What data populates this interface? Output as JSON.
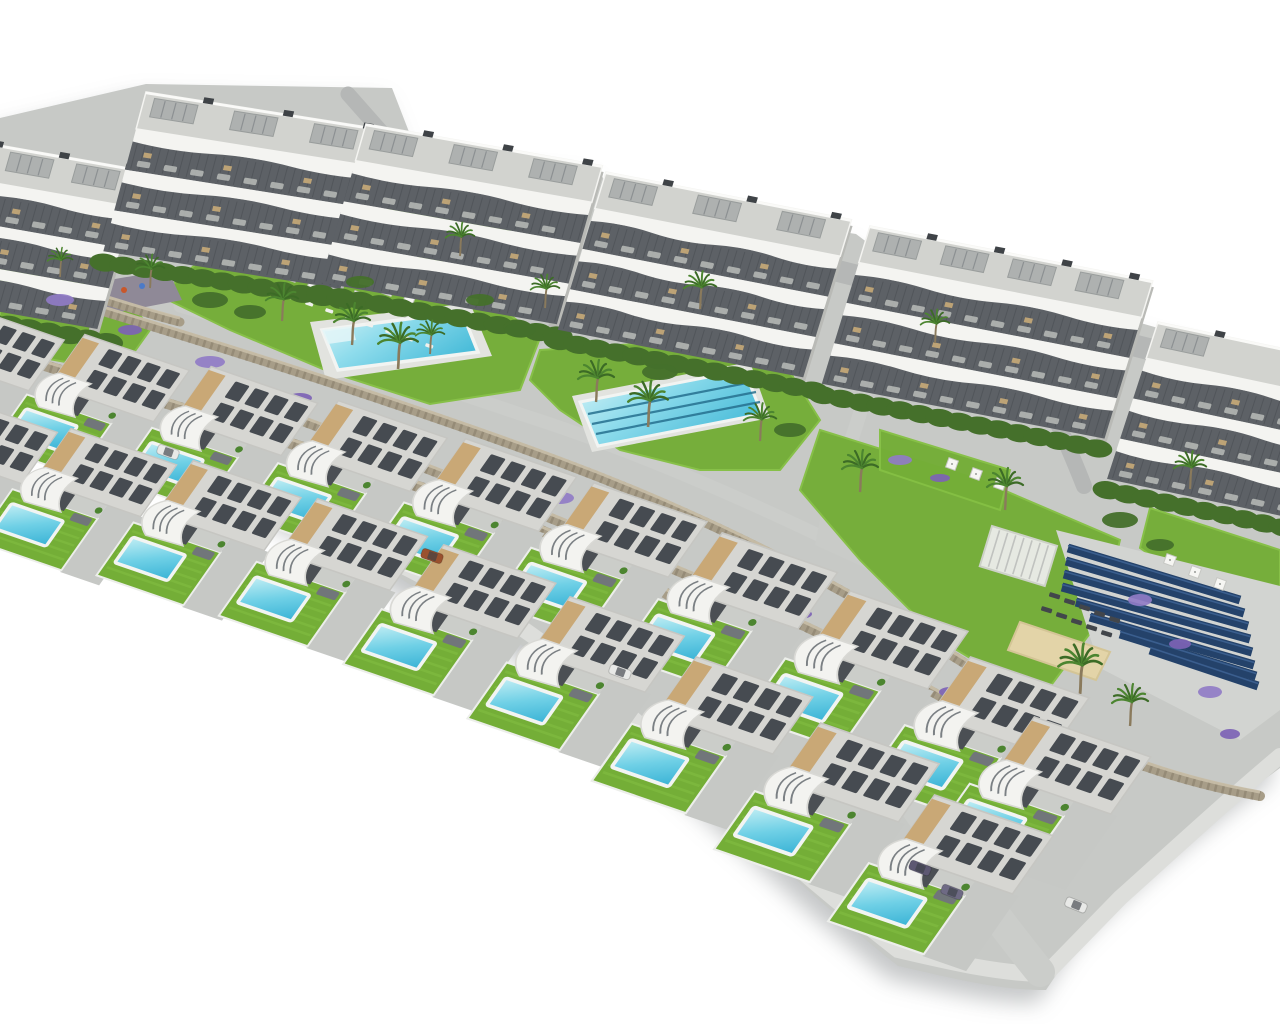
{
  "image": {
    "kind": "aerial-architectural-render",
    "description": "Aerial 3D rendering of a hillside residential development: six curved-balcony apartment blocks at the back, communal gardens with a leisure pool and a lap pool, stone terracing walls, palm trees and lavender, a pergola, sunbeds, a sand court and a solar panel field, and two staggered rows of modern villas with private pools in front, on a white background",
    "background": "#ffffff"
  },
  "palette": {
    "concrete_base": "#c7c9c6",
    "sidewalk": "#dddedb",
    "road": "#b5b7b6",
    "path": "#cbcdca",
    "plaza": "#c9cbc8",
    "lawn": "#74ae37",
    "lawn_light": "#85c044",
    "hedge_dark": "#45702b",
    "hedge_light": "#548833",
    "pool_deck": "#e2e3df",
    "pool_rim": "#f2f4f2",
    "water_light": "#c2eef4",
    "water_mid": "#6fd0e6",
    "water_deep": "#38b2d5",
    "lane_line": "#26708f",
    "stone_light": "#c9bfa8",
    "stone_mid": "#a79d88",
    "stone_dark": "#837a66",
    "lavender": "#7d63b5",
    "lavender_light": "#907cc6",
    "palm_frond": "#4c8530",
    "palm_frond_dark": "#3c6b26",
    "palm_trunk": "#8a7a5c",
    "building_white": "#f4f4f1",
    "building_recess": "#5d6166",
    "building_slat": "#474b50",
    "building_deck": "#d2d3cf",
    "building_pergola": "#aeb1b0",
    "building_shade": "#b9bab6",
    "villa_roof": "#d6d6d2",
    "villa_roof_edge": "#c6c6c2",
    "villa_panel": "#464b51",
    "villa_beige": "#c9a876",
    "villa_white": "#f3f3f0",
    "villa_stair": "#7b8084",
    "villa_terrace": "#cbcdc9",
    "villa_sofa": "#71767a",
    "driveway": "#c6c8c5",
    "porch_dark": "#4b4f54",
    "solar_pad": "#d2d4d1",
    "solar_panel": "#24426a",
    "solar_panel_light": "#3a5e8e",
    "sand": "#e3d4a8",
    "playground": "#8f8997",
    "umbrella": "#f6f6f3",
    "sunbed_dark": "#42464b",
    "furniture_light": "#b9bcb9",
    "furniture_tan": "#c8ab78"
  },
  "scene": {
    "site_outline": "M0,118 L146,84 L392,88 L416,150 L598,168 L612,196 L856,234 L872,246 L1158,328 L1280,360 L1280,768 C1236,800 1150,866 1082,936 L1046,990 C996,990 952,978 898,966 C806,892 742,830 668,766 C592,698 508,622 428,596 C340,538 218,480 120,448 C78,436 36,430 0,424 Z",
    "sidewalk_paths": [
      "M0,408 C120,430 300,512 430,580 C510,606 590,680 668,750 C740,818 806,878 898,950 C950,962 1000,974 1046,974",
      "M1046,974 L1120,898 C1180,844 1230,798 1280,756"
    ],
    "roads": [
      {
        "d": "M826,268 L1280,382",
        "w": 22
      },
      {
        "d": "M348,94 L424,180 L478,214",
        "w": 15
      },
      {
        "d": "M1084,486 C1070,450 1056,420 1046,396",
        "w": 16
      }
    ],
    "paths": [
      {
        "d": "M180,306 C300,340 420,380 520,414 C640,452 760,506 870,560 C940,596 1000,630 1060,664",
        "w": 13
      },
      {
        "d": "M610,230 C600,280 575,320 545,350",
        "w": 12
      },
      {
        "d": "M870,300 C880,360 860,420 840,470",
        "w": 14
      },
      {
        "d": "M880,760 C940,840 990,910 1040,972",
        "w": 30
      }
    ],
    "plazas": [
      "830,470 950,520 925,595 815,545",
      "560,335 640,362 620,392 545,362"
    ],
    "lawns": [
      "196,264 330,270 470,284 540,338 520,390 430,404 330,372 230,330 160,296",
      "540,350 700,340 790,372 820,420 780,470 700,470 620,450 560,410 530,380",
      "820,430 980,480 1120,540 1100,620 1040,700 940,640 860,560 800,490",
      "1150,508 1280,550 1280,606 1190,582 1140,548",
      "0,262 120,285 150,330 120,372 0,350",
      "390,200 500,212 520,250 430,262 386,240",
      "880,430 1010,470 1000,510 880,470"
    ],
    "playground": {
      "points": "74,286 168,270 182,300 88,318",
      "dots": [
        [
          104,
          296,
          "#d9a32b"
        ],
        [
          124,
          290,
          "#c8572b"
        ],
        [
          142,
          286,
          "#4c7ac8"
        ]
      ]
    },
    "leisure_pool": {
      "deck": "310,322 470,303 492,356 326,380",
      "water": "322,330 462,312 478,352 338,370",
      "step": "322,330 352,326 356,340 328,344"
    },
    "lap_pool": {
      "deck": "572,396 750,362 770,418 592,452",
      "water": "580,402 744,370 762,414 598,446",
      "lanes": [
        [
          588,
          414,
          752,
          382
        ],
        [
          592,
          424,
          756,
          392
        ],
        [
          596,
          434,
          760,
          402
        ]
      ]
    },
    "walls": [
      {
        "d": "M40,280 C90,295 140,312 180,322",
        "w": 9
      },
      {
        "d": "M60,298 C240,352 420,410 560,462 C700,514 820,576 920,636 C1000,684 1060,724 1100,760",
        "w": 10
      },
      {
        "d": "M300,420 C460,480 620,545 780,615 C880,660 960,706 1030,750",
        "w": 10
      },
      {
        "d": "M0,352 C180,406 360,464 540,530 C660,582 760,650 850,710 C900,746 950,790 1000,840",
        "w": 11
      },
      {
        "d": "M1040,720 C1100,752 1170,780 1260,796",
        "w": 10
      }
    ],
    "solar_array": {
      "pad": "1056,530 1280,586 1280,710 1240,740 1100,668",
      "stripes": [
        [
          1068,
          548,
          1240,
          600
        ],
        [
          1066,
          561,
          1244,
          613
        ],
        [
          1064,
          574,
          1248,
          626
        ],
        [
          1062,
          587,
          1250,
          639
        ],
        [
          1076,
          602,
          1252,
          652
        ],
        [
          1090,
          617,
          1254,
          665
        ],
        [
          1120,
          634,
          1256,
          676
        ],
        [
          1150,
          650,
          1258,
          686
        ]
      ]
    },
    "pergola": {
      "x": 992,
      "y": 526,
      "rot": 17,
      "w": 68,
      "h": 42
    },
    "sand_court": {
      "points": "1020,622 1110,652 1096,680 1008,650"
    },
    "sunbeds_dark": {
      "rows": [
        {
          "x": 1050,
          "y": 592,
          "n": 5,
          "dx": 15,
          "dy": 6
        },
        {
          "x": 1042,
          "y": 606,
          "n": 5,
          "dx": 15,
          "dy": 6
        }
      ]
    },
    "sunbeds_white": {
      "rows": [
        {
          "x": 286,
          "y": 294,
          "n": 8,
          "dx": 20,
          "dy": 7
        }
      ]
    },
    "parasols": [
      [
        300,
        262
      ],
      [
        322,
        269
      ],
      [
        344,
        276
      ],
      [
        366,
        283
      ],
      [
        388,
        290
      ],
      [
        410,
        297
      ],
      [
        292,
        276
      ],
      [
        314,
        283
      ],
      [
        336,
        290
      ],
      [
        358,
        297
      ],
      [
        380,
        304
      ],
      [
        402,
        311
      ],
      [
        690,
        318
      ],
      [
        712,
        326
      ],
      [
        952,
        464
      ],
      [
        976,
        474
      ],
      [
        1000,
        484
      ],
      [
        1170,
        560
      ],
      [
        1195,
        572
      ],
      [
        1220,
        584
      ]
    ],
    "apartment_buildings": [
      {
        "x": -64,
        "y": 134,
        "w": 210,
        "rot": 10
      },
      {
        "x": 146,
        "y": 92,
        "w": 240,
        "rot": 9
      },
      {
        "x": 366,
        "y": 124,
        "w": 240,
        "rot": 10
      },
      {
        "x": 606,
        "y": 172,
        "w": 250,
        "rot": 11
      },
      {
        "x": 870,
        "y": 226,
        "w": 288,
        "rot": 11
      },
      {
        "x": 1158,
        "y": 322,
        "w": 200,
        "rot": 12
      }
    ],
    "villas_back": [
      {
        "x": -52,
        "y": 300,
        "s": 0.96
      },
      {
        "x": 72,
        "y": 330,
        "s": 0.97
      },
      {
        "x": 198,
        "y": 362,
        "s": 0.99
      },
      {
        "x": 325,
        "y": 396,
        "s": 1.01
      },
      {
        "x": 452,
        "y": 434,
        "s": 1.03
      },
      {
        "x": 580,
        "y": 478,
        "s": 1.05
      },
      {
        "x": 708,
        "y": 528,
        "s": 1.07
      },
      {
        "x": 836,
        "y": 586,
        "s": 1.09
      },
      {
        "x": 956,
        "y": 652,
        "s": 1.1
      },
      {
        "x": 1020,
        "y": 712,
        "s": 1.08
      }
    ],
    "villas_front": [
      {
        "x": -60,
        "y": 392,
        "s": 0.97
      },
      {
        "x": 58,
        "y": 424,
        "s": 0.98
      },
      {
        "x": 180,
        "y": 456,
        "s": 1.0
      },
      {
        "x": 304,
        "y": 494,
        "s": 1.02
      },
      {
        "x": 430,
        "y": 540,
        "s": 1.04
      },
      {
        "x": 556,
        "y": 592,
        "s": 1.06
      },
      {
        "x": 682,
        "y": 652,
        "s": 1.08
      },
      {
        "x": 806,
        "y": 718,
        "s": 1.1
      },
      {
        "x": 920,
        "y": 790,
        "s": 1.1
      }
    ],
    "palms": [
      [
        352,
        335,
        1.0
      ],
      [
        398,
        358,
        1.1
      ],
      [
        430,
        346,
        0.8
      ],
      [
        596,
        392,
        1.0
      ],
      [
        648,
        416,
        1.1
      ],
      [
        700,
        300,
        0.9
      ],
      [
        545,
        300,
        0.8
      ],
      [
        760,
        432,
        0.9
      ],
      [
        860,
        482,
        1.0
      ],
      [
        1005,
        500,
        1.0
      ],
      [
        1080,
        682,
        1.2
      ],
      [
        1130,
        716,
        1.0
      ],
      [
        1190,
        480,
        0.9
      ],
      [
        935,
        335,
        0.8
      ],
      [
        460,
        248,
        0.8
      ],
      [
        150,
        280,
        0.8
      ],
      [
        60,
        270,
        0.7
      ],
      [
        282,
        312,
        0.9
      ]
    ],
    "lavender": [
      [
        60,
        300,
        14,
        6
      ],
      [
        130,
        330,
        12,
        5
      ],
      [
        210,
        362,
        15,
        6
      ],
      [
        300,
        398,
        12,
        5
      ],
      [
        390,
        432,
        14,
        6
      ],
      [
        470,
        462,
        11,
        5
      ],
      [
        560,
        498,
        14,
        6
      ],
      [
        640,
        535,
        12,
        5
      ],
      [
        720,
        574,
        14,
        6
      ],
      [
        800,
        614,
        12,
        5
      ],
      [
        880,
        655,
        14,
        6
      ],
      [
        950,
        692,
        11,
        5
      ],
      [
        1010,
        726,
        13,
        6
      ],
      [
        1080,
        762,
        11,
        5
      ],
      [
        1140,
        600,
        12,
        6
      ],
      [
        1180,
        644,
        11,
        5
      ],
      [
        1210,
        692,
        12,
        6
      ],
      [
        1230,
        734,
        10,
        5
      ],
      [
        900,
        460,
        12,
        5
      ],
      [
        940,
        478,
        10,
        4
      ]
    ],
    "hedges_extra": [
      [
        210,
        300,
        18,
        8
      ],
      [
        250,
        312,
        16,
        7
      ],
      [
        520,
        330,
        16,
        7
      ],
      [
        660,
        372,
        18,
        8
      ],
      [
        790,
        430,
        16,
        7
      ],
      [
        1120,
        520,
        18,
        8
      ],
      [
        1160,
        545,
        14,
        6
      ],
      [
        480,
        300,
        14,
        6
      ],
      [
        360,
        282,
        14,
        6
      ]
    ],
    "cars": [
      {
        "x": 168,
        "y": 452,
        "rot": 19,
        "c": "#e8e9e7"
      },
      {
        "x": 432,
        "y": 556,
        "rot": 19,
        "c": "#9a512e"
      },
      {
        "x": 620,
        "y": 672,
        "rot": 20,
        "c": "#e8e9e7"
      },
      {
        "x": 920,
        "y": 868,
        "rot": 21,
        "c": "#5d5872"
      },
      {
        "x": 952,
        "y": 892,
        "rot": 21,
        "c": "#6e6a84"
      },
      {
        "x": 1076,
        "y": 905,
        "rot": 22,
        "c": "#e8e9e7"
      }
    ]
  }
}
